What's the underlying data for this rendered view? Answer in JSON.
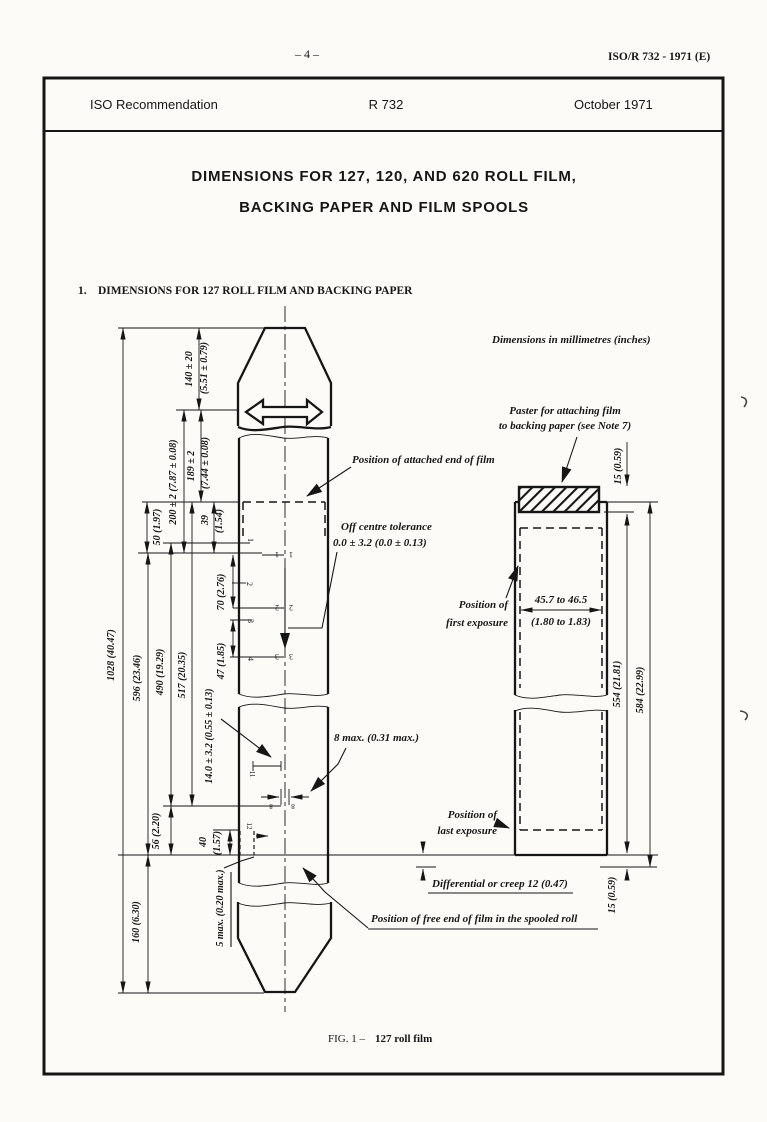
{
  "page": {
    "number": "– 4 –",
    "reference": "ISO/R 732 - 1971 (E)"
  },
  "header_row": {
    "left": "ISO Recommendation",
    "center": "R 732",
    "right": "October 1971"
  },
  "title": {
    "line1": "DIMENSIONS FOR 127, 120, AND 620 ROLL FILM,",
    "line2": "BACKING PAPER AND FILM SPOOLS"
  },
  "section": {
    "number": "1.",
    "heading": "DIMENSIONS FOR 127 ROLL FILM AND BACKING PAPER"
  },
  "units_note": "Dimensions in millimetres (inches)",
  "figure": {
    "caption": "FIG. 1  –",
    "caption_subject": "127 roll film",
    "dims": {
      "len1028": "1028 (40.47)",
      "len596": "596 (23.46)",
      "len490": "490 (19.29)",
      "len517": "517 (20.35)",
      "len160": "160 (6.30)",
      "len56": "56 (2.20)",
      "len140_mm": "140 ± 20",
      "len140_in": "(5.51 ± 0.79)",
      "len200": "200 ± 2 (7.87 ± 0.08)",
      "len189_mm": "189 ± 2",
      "len189_in": "(7.44 ± 0.08)",
      "len50": "50 (1.97)",
      "len39_mm": "39",
      "len39_in": "(1.54)",
      "len70": "70 (2.76)",
      "len47": "47 (1.85)",
      "len14": "14.0 ± 3.2 (0.55 ± 0.13)",
      "len40_mm": "40",
      "len40_in": "(1.57)",
      "len5max": "5 max. (0.20 max.)",
      "len8max": "8 max. (0.31 max.)"
    },
    "frames": {
      "n1": "1",
      "n2": "2",
      "n3": "3",
      "n4": "4",
      "n8": "8",
      "n11": "11",
      "n12": "12"
    },
    "notes": {
      "attached_end": "Position of attached end of film",
      "off_centre_1": "Off centre tolerance",
      "off_centre_2": "0.0 ± 3.2 (0.0 ± 0.13)",
      "free_end": "Position of free end of film in the spooled roll"
    },
    "film_strip": {
      "paster_1": "Paster for attaching film",
      "paster_2": "to backing paper (see Note 7)",
      "len15_top": "15 (0.59)",
      "len15_bottom": "15 (0.59)",
      "first_exposure_1": "Position of",
      "first_exposure_2": "first exposure",
      "width_mm": "45.7 to 46.5",
      "width_in": "(1.80 to 1.83)",
      "len554": "554 (21.81)",
      "len584": "584 (22.99)",
      "last_exposure_1": "Position of",
      "last_exposure_2": "last exposure",
      "creep": "Differential or creep 12 (0.47)"
    }
  }
}
